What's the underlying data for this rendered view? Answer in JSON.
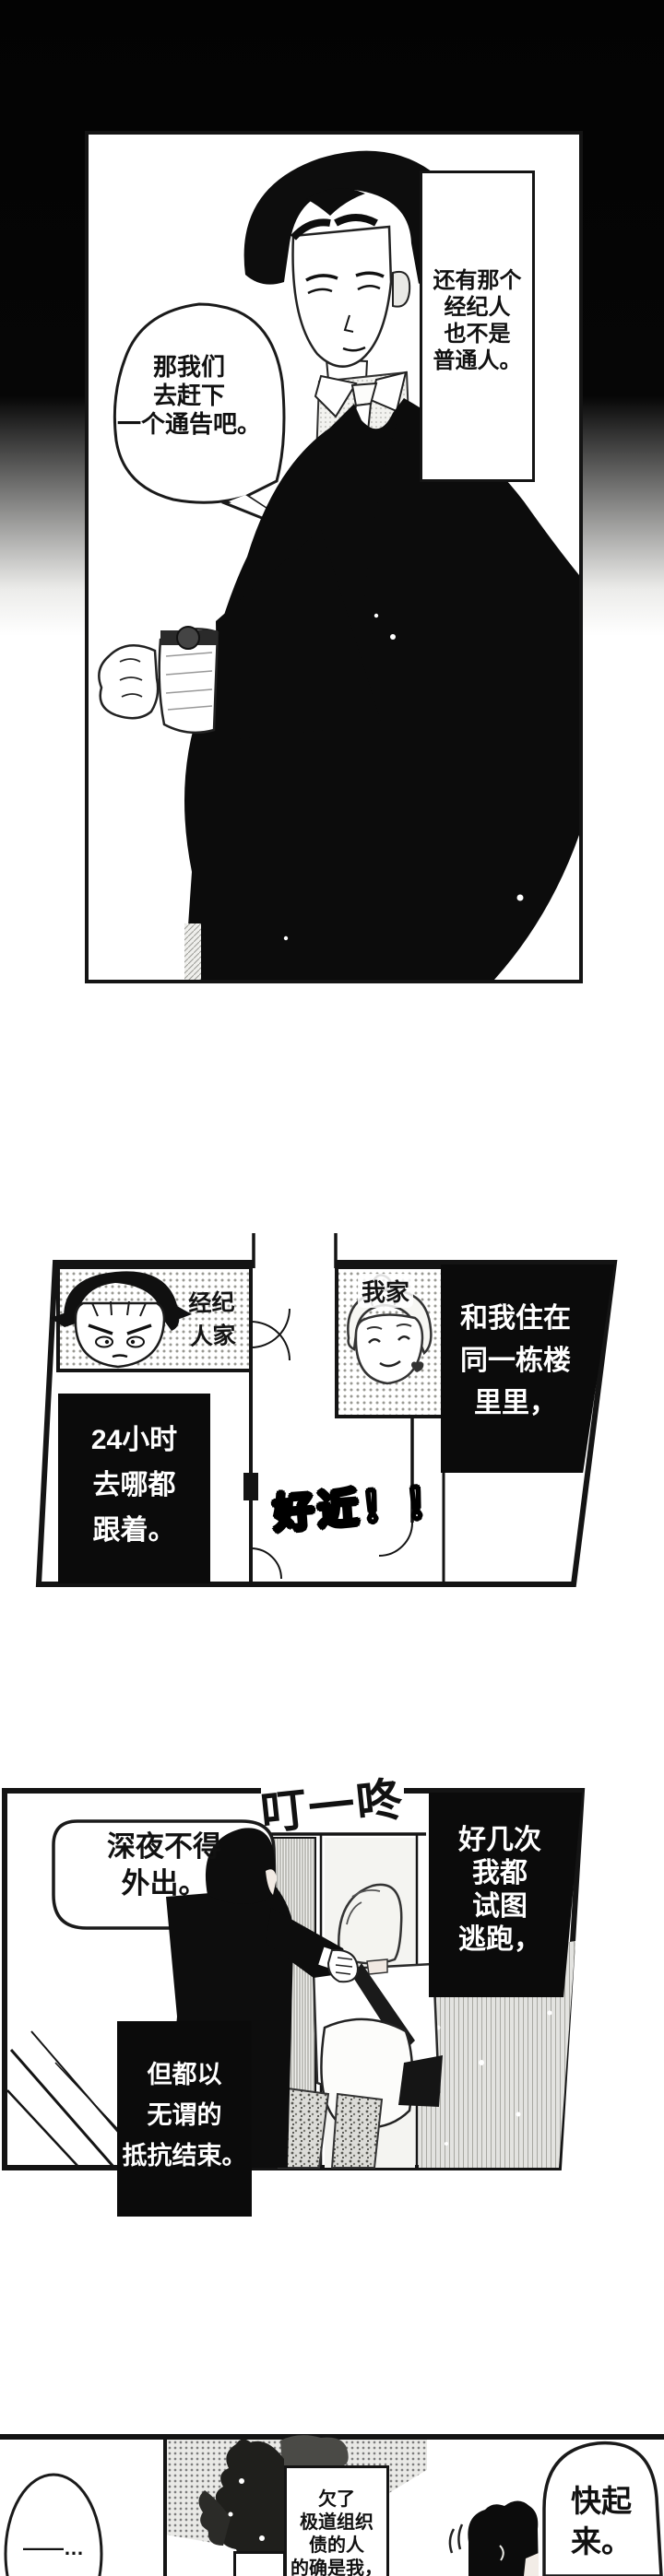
{
  "panel1": {
    "bubble_lines": [
      "那我们",
      "去赶下",
      "一个通告吧。"
    ],
    "caption_lines": [
      "还有那个",
      "经纪人",
      "也不是",
      "普通人。"
    ]
  },
  "panel2": {
    "manager_label_lines": [
      "经纪",
      "人家"
    ],
    "home_label": "我家",
    "caption_live_lines": [
      "和我住在",
      "同一栋楼",
      "里里，"
    ],
    "caption_follow_lines": [
      "24小时",
      "去哪都",
      "跟着。"
    ],
    "sfx_close": "好近！！"
  },
  "panel3": {
    "sfx_doorbell": "叮一咚",
    "bubble_lines": [
      "深夜不得",
      "外出。"
    ],
    "caption_escape_lines": [
      "好几次",
      "我都",
      "试图",
      "逃跑，"
    ],
    "caption_resist_lines": [
      "但都以",
      "无谓的",
      "抵抗结束。"
    ]
  },
  "panel4": {
    "dash_bubble": "——…",
    "caption_debt_lines": [
      "欠了",
      "极道组织",
      "债的人",
      "的确是我，"
    ],
    "bubble_getup_lines": [
      "快起",
      "来。"
    ]
  }
}
